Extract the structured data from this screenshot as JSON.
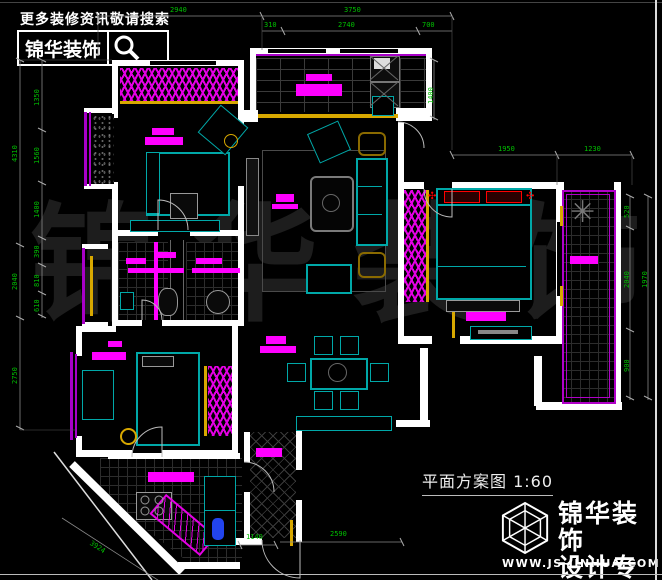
{
  "header": {
    "tagline": "更多装修资讯敬请搜索",
    "brand": "锦华装饰",
    "search_icon": "magnifier"
  },
  "footer": {
    "plan_label": "平面方案图 1:60",
    "brand": "锦华装饰",
    "brand_subtitle": "设计专家",
    "website": "WWW.JS-JINHUA.COM",
    "logo_icon": "wireframe-cube"
  },
  "watermark": {
    "text": "锦华装饰",
    "chars": [
      "锦",
      "华",
      "装",
      "饰"
    ]
  },
  "colors": {
    "dimension_green": "#00c000",
    "furniture_magenta": "#ff00ff",
    "outline_teal": "#00a8a8",
    "accent_yellow": "#d8a800",
    "balcony_purple": "#a800c8",
    "wall_white": "#ffffff",
    "background": "#000000"
  },
  "dims": [
    {
      "v": "2940"
    },
    {
      "v": "3750"
    },
    {
      "v": "310"
    },
    {
      "v": "2740"
    },
    {
      "v": "700"
    },
    {
      "v": "1400"
    },
    {
      "v": "1950"
    },
    {
      "v": "1230"
    },
    {
      "v": "520"
    },
    {
      "v": "2040"
    },
    {
      "v": "1970"
    },
    {
      "v": "900"
    },
    {
      "v": "4310"
    },
    {
      "v": "2040"
    },
    {
      "v": "2750"
    },
    {
      "v": "1350"
    },
    {
      "v": "1560"
    },
    {
      "v": "1400"
    },
    {
      "v": "390"
    },
    {
      "v": "810"
    },
    {
      "v": "610"
    },
    {
      "v": "3924"
    },
    {
      "v": "1140"
    },
    {
      "v": "2590"
    }
  ]
}
